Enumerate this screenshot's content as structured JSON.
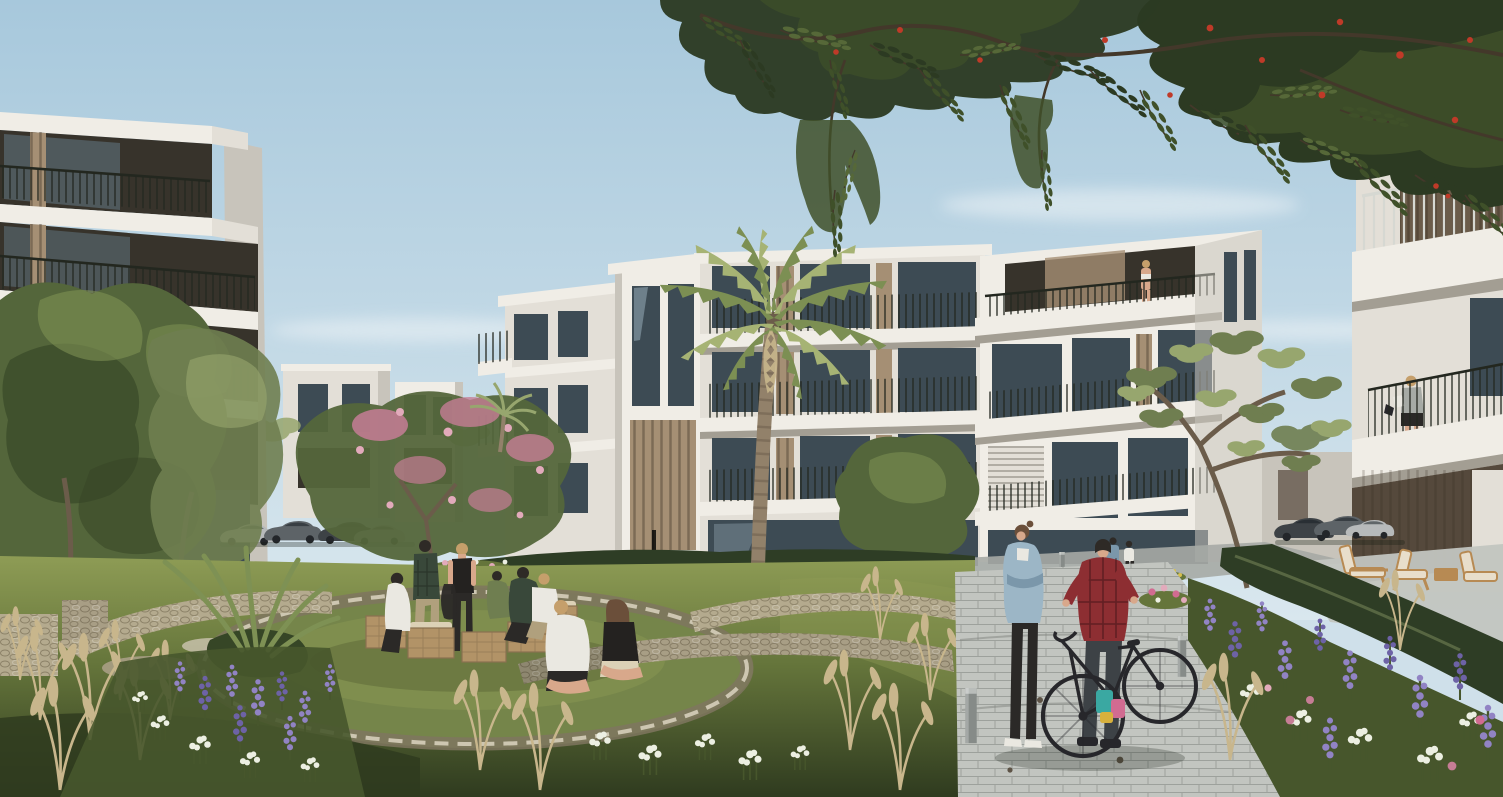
{
  "scene": {
    "type": "architectural rendering",
    "description": "Sunlit rendering of a modern white low-rise apartment community: tiered buildings with cantilevered balconies surround a landscaped courtyard. A group of friends gathers on wooden crates in a sunken circular lawn, a couple sits on a curved stone edge, and a woman in a denim jacket talks with a man in a red plaid shirt holding a black bicycle on a paver path. A flame tree canopy with red blossoms overhangs the sky and a tall palm rises before the facades.",
    "time_of_day": "daytime, clear pale-blue sky",
    "buildings": [
      {
        "id": "left-building",
        "style": "white modern tiers, cantilevered balconies, black metal railings, dark glazing, wood-slat accents",
        "visible_floors": 4
      },
      {
        "id": "center-building-complex",
        "style": "staggered white volumes with wrap balconies and wood-slat piers",
        "visible_floors": 4,
        "features": [
          "large palm in front",
          "resident standing at top-floor balcony rail"
        ]
      },
      {
        "id": "right-building",
        "style": "white volumes with deep balcony slabs and slatted screens",
        "visible_floors": 3,
        "features": [
          "woman reading on balcony"
        ]
      },
      {
        "id": "background-buildings",
        "style": "low white and grey blocks between the main volumes"
      }
    ],
    "vegetation": [
      "flame-tree canopy with red blossoms overhanging the top",
      "tall palm tree",
      "small fan palm",
      "pink flowering tree",
      "airy olive trees",
      "rounded green courtyard trees",
      "clipped dark hedges",
      "ornamental tan grass plumes",
      "purple salvia spikes",
      "white yarrow clusters",
      "pink perennials",
      "sunken circular lawn"
    ],
    "people": [
      {
        "id": "crate-circle-group",
        "count": 7,
        "note": "friends seated and standing around wooden crates on the sunken lawn"
      },
      {
        "id": "seated-couple",
        "count": 2,
        "note": "man in white tee and woman in black top seated on the curved stone edge"
      },
      {
        "id": "path-pair",
        "count": 2,
        "note": "woman in denim jacket; man in red plaid shirt wheeling a black bicycle with colorful panniers"
      },
      {
        "id": "background-walkers",
        "count": 2
      },
      {
        "id": "right-balcony-woman",
        "count": 1,
        "note": "reading on the right building balcony"
      },
      {
        "id": "center-balcony-person",
        "count": 1,
        "note": "standing at the top balcony rail of the center building"
      }
    ],
    "objects": [
      "wooden crate seats",
      "black city bicycle with teal, pink and yellow panniers",
      "grey bollards",
      "timber lounge chairs on a terrace",
      "parked cars between buildings",
      "curved gabion stone walls",
      "stone ring seat wall",
      "small rectangular paver walkway",
      "garden light posts"
    ],
    "counts": {
      "people_total": 15,
      "crates": 5,
      "bollards": 3,
      "lounge_chairs": 3,
      "parked_cars": 7,
      "bicycles": 1
    }
  },
  "palette": {
    "sky_top": "#a7c8dc",
    "sky_low": "#d9e7ee",
    "cloud": "#edf3f6",
    "white_sun": "#f0ede6",
    "white_lit": "#e3dfd7",
    "white_shade": "#c8c4bb",
    "slab_shadow": "#a39e93",
    "underside": "#8b867b",
    "dark_recess": "#37332b",
    "brown_recess": "#55493c",
    "glass_dark": "#3d4b54",
    "glass_mid": "#647985",
    "glass_light": "#a0b5c1",
    "wood_slat": "#a58f74",
    "wood_dark": "#6b5c4a",
    "branch": "#43382a",
    "railing_dark": "#23271f",
    "railing_light": "#d6d8d2",
    "canopy_dark": "#2c3a22",
    "canopy_mid": "#3f5029",
    "canopy_light": "#566838",
    "flower_red": "#bf3a28",
    "palm_green": "#7c8f53",
    "palm_light": "#a6b374",
    "palm_trunk": "#92816a",
    "palm_trunk_dark": "#6d5e4d",
    "olive_green": "#6f7e50",
    "olive_light": "#97a66e",
    "tree_green": "#54663b",
    "tree_dark": "#364626",
    "tree_light": "#7e9154",
    "pink_bloom": "#c67d95",
    "pink_light": "#e2aabb",
    "grass_sun": "#8e9c55",
    "grass_mid": "#65753b",
    "grass_dark": "#47562c",
    "grass_deep": "#2f3b1f",
    "lawn": "#75854a",
    "hedge": "#2e3d25",
    "stone_light": "#cdc6b1",
    "stone_mid": "#a89e85",
    "stone_dark": "#7f765f",
    "gabion": "#b4aa8e",
    "path_light": "#c2c5c0",
    "path_mid": "#a6aaa5",
    "path_dark": "#7f847e",
    "flower_purple": "#9183c4",
    "flower_violet": "#6d62a6",
    "flower_white": "#ecefe2",
    "flower_yellow": "#d6bf4e",
    "plume": "#c8b68c",
    "skin": "#d8a88b",
    "hair_dark": "#2e2a26",
    "hair_blonde": "#c59f6b",
    "hair_brown": "#6b4f3a",
    "denim": "#9cb6c6",
    "denim_dark": "#7b97aa",
    "shirt_red": "#8d2e32",
    "shirt_white": "#eae8e1",
    "shirt_black": "#242220",
    "shirt_green": "#39483a",
    "khaki": "#b0a07d",
    "pants_dark": "#2b2927",
    "bike_dark": "#27272b",
    "bag_teal": "#3aa8a2",
    "bag_pink": "#d16b91",
    "bag_yellow": "#d7b13d",
    "car_silver": "#b7babb",
    "car_dark": "#5d6367",
    "car_deep": "#3d4246",
    "crate_wood": "#b29367",
    "crate_dark": "#8a7150",
    "cushion": "#dcd1b6",
    "lounger_wood": "#b78a53",
    "lounger_cushion": "#e8decb"
  }
}
